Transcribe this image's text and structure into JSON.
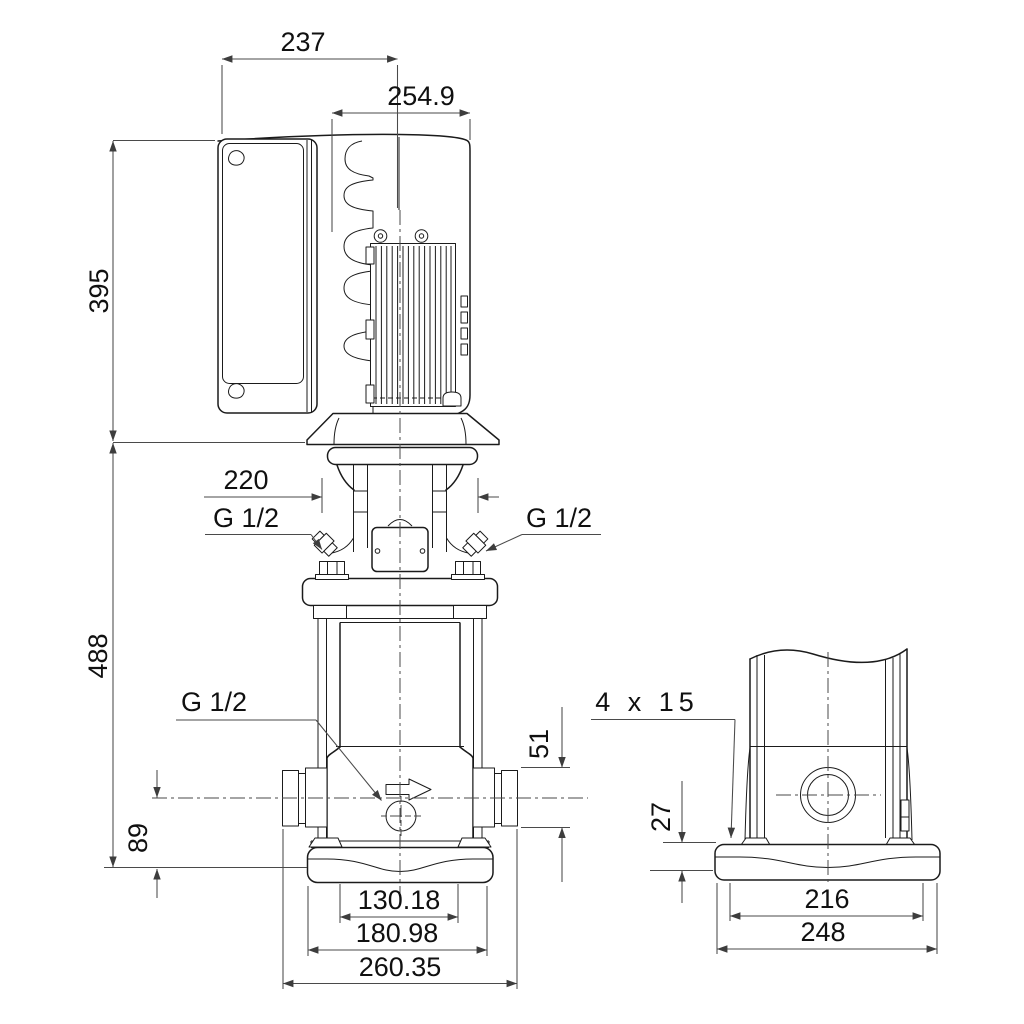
{
  "title": "pump-dimensional-drawing",
  "colors": {
    "background": "#ffffff",
    "line": "#1b1b1b",
    "dimension_line": "#4a4a4a"
  },
  "front_view": {
    "top_width_mm": "237",
    "motor_width_mm": "254.9",
    "motor_height_mm": "395",
    "coupling_width_mm": "220",
    "left_plug_thread": "G 1/2",
    "right_plug_thread": "G 1/2",
    "pump_height_mm": "488",
    "drain_thread": "G 1/2",
    "port_flange_height_mm": "51",
    "port_center_height_mm": "89",
    "base_inner_width_mm": "130.18",
    "base_width_mm": "180.98",
    "port_to_port_mm": "260.35"
  },
  "side_view": {
    "mounting_slot": "4 x 15",
    "base_height_mm": "27",
    "base_inner_width_mm": "216",
    "base_width_mm": "248"
  }
}
